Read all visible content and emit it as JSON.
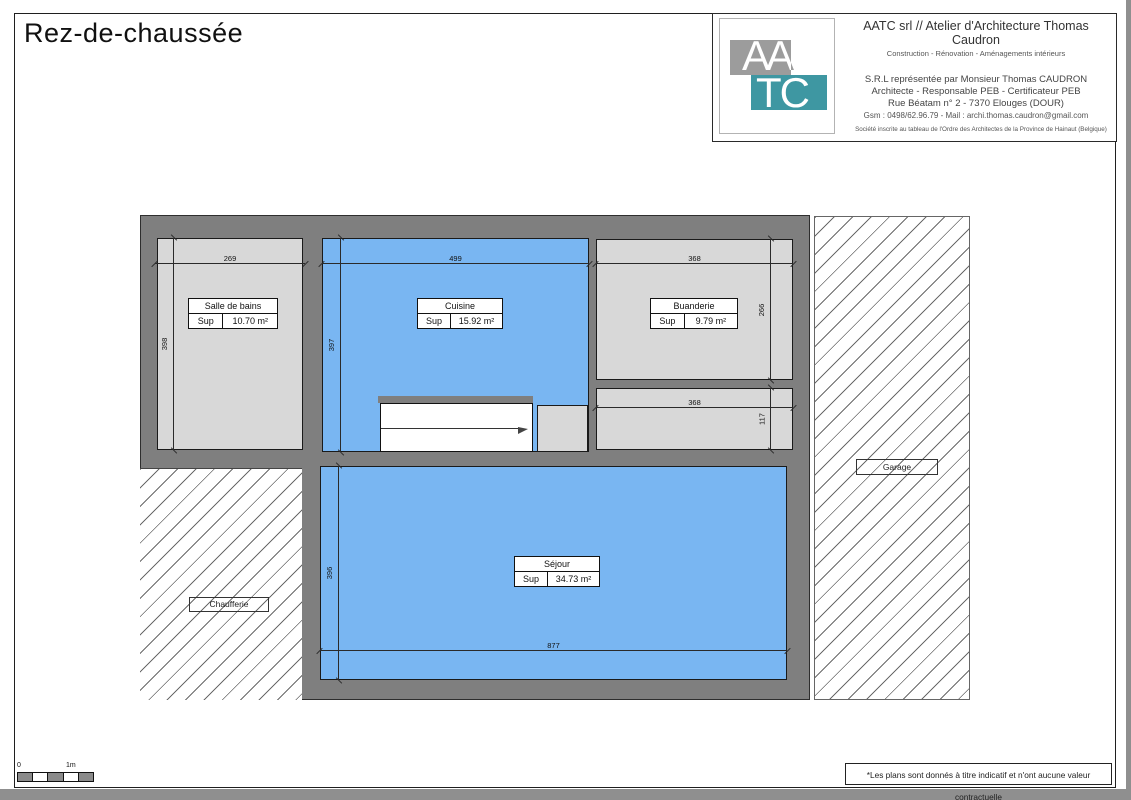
{
  "page": {
    "title": "Rez-de-chaussée",
    "footer_note": "*Les plans sont donnés à titre indicatif et n'ont aucune valeur contractuelle",
    "scale": {
      "zero": "0",
      "one_m": "1m"
    }
  },
  "title_block": {
    "logo": {
      "aa": "AA",
      "tc": "TC"
    },
    "firm_line1": "AATC srl // Atelier d'Architecture Thomas Caudron",
    "firm_line2": "Construction - Rénovation - Aménagements intérieurs",
    "rep_line1": "S.R.L représentée par Monsieur Thomas CAUDRON",
    "rep_line2": "Architecte - Responsable PEB - Certificateur PEB",
    "rep_line3": "Rue Béatam n° 2 - 7370 Elouges (DOUR)",
    "rep_line4": "Gsm : 0498/62.96.79 - Mail : archi.thomas.caudron@gmail.com",
    "registration": "Société inscrite au tableau de l'Ordre des Architectes de la Province de Hainaut (Belgique)"
  },
  "rooms": {
    "salle_de_bains": {
      "name": "Salle de bains",
      "sup_label": "Sup",
      "area": "10.70 m²"
    },
    "cuisine": {
      "name": "Cuisine",
      "sup_label": "Sup",
      "area": "15.92 m²"
    },
    "buanderie": {
      "name": "Buanderie",
      "sup_label": "Sup",
      "area": "9.79 m²"
    },
    "sejour": {
      "name": "Séjour",
      "sup_label": "Sup",
      "area": "34.73 m²"
    },
    "chaufferie": {
      "name": "Chaufferie"
    },
    "garage": {
      "name": "Garage"
    }
  },
  "dimensions": {
    "sdb_width": "269",
    "sdb_height": "398",
    "cuisine_width": "499",
    "cuisine_height": "397",
    "buanderie_width": "368",
    "buanderie_height": "266",
    "hall_width": "368",
    "hall_height": "117",
    "sejour_width": "877",
    "sejour_height": "396"
  },
  "colors": {
    "wall": "#7f7f7f",
    "room_fill": "#d8d8d8",
    "floor_blue": "#79b6f2",
    "logo_teal": "#3e97a2",
    "logo_gray": "#9c9c9c"
  }
}
